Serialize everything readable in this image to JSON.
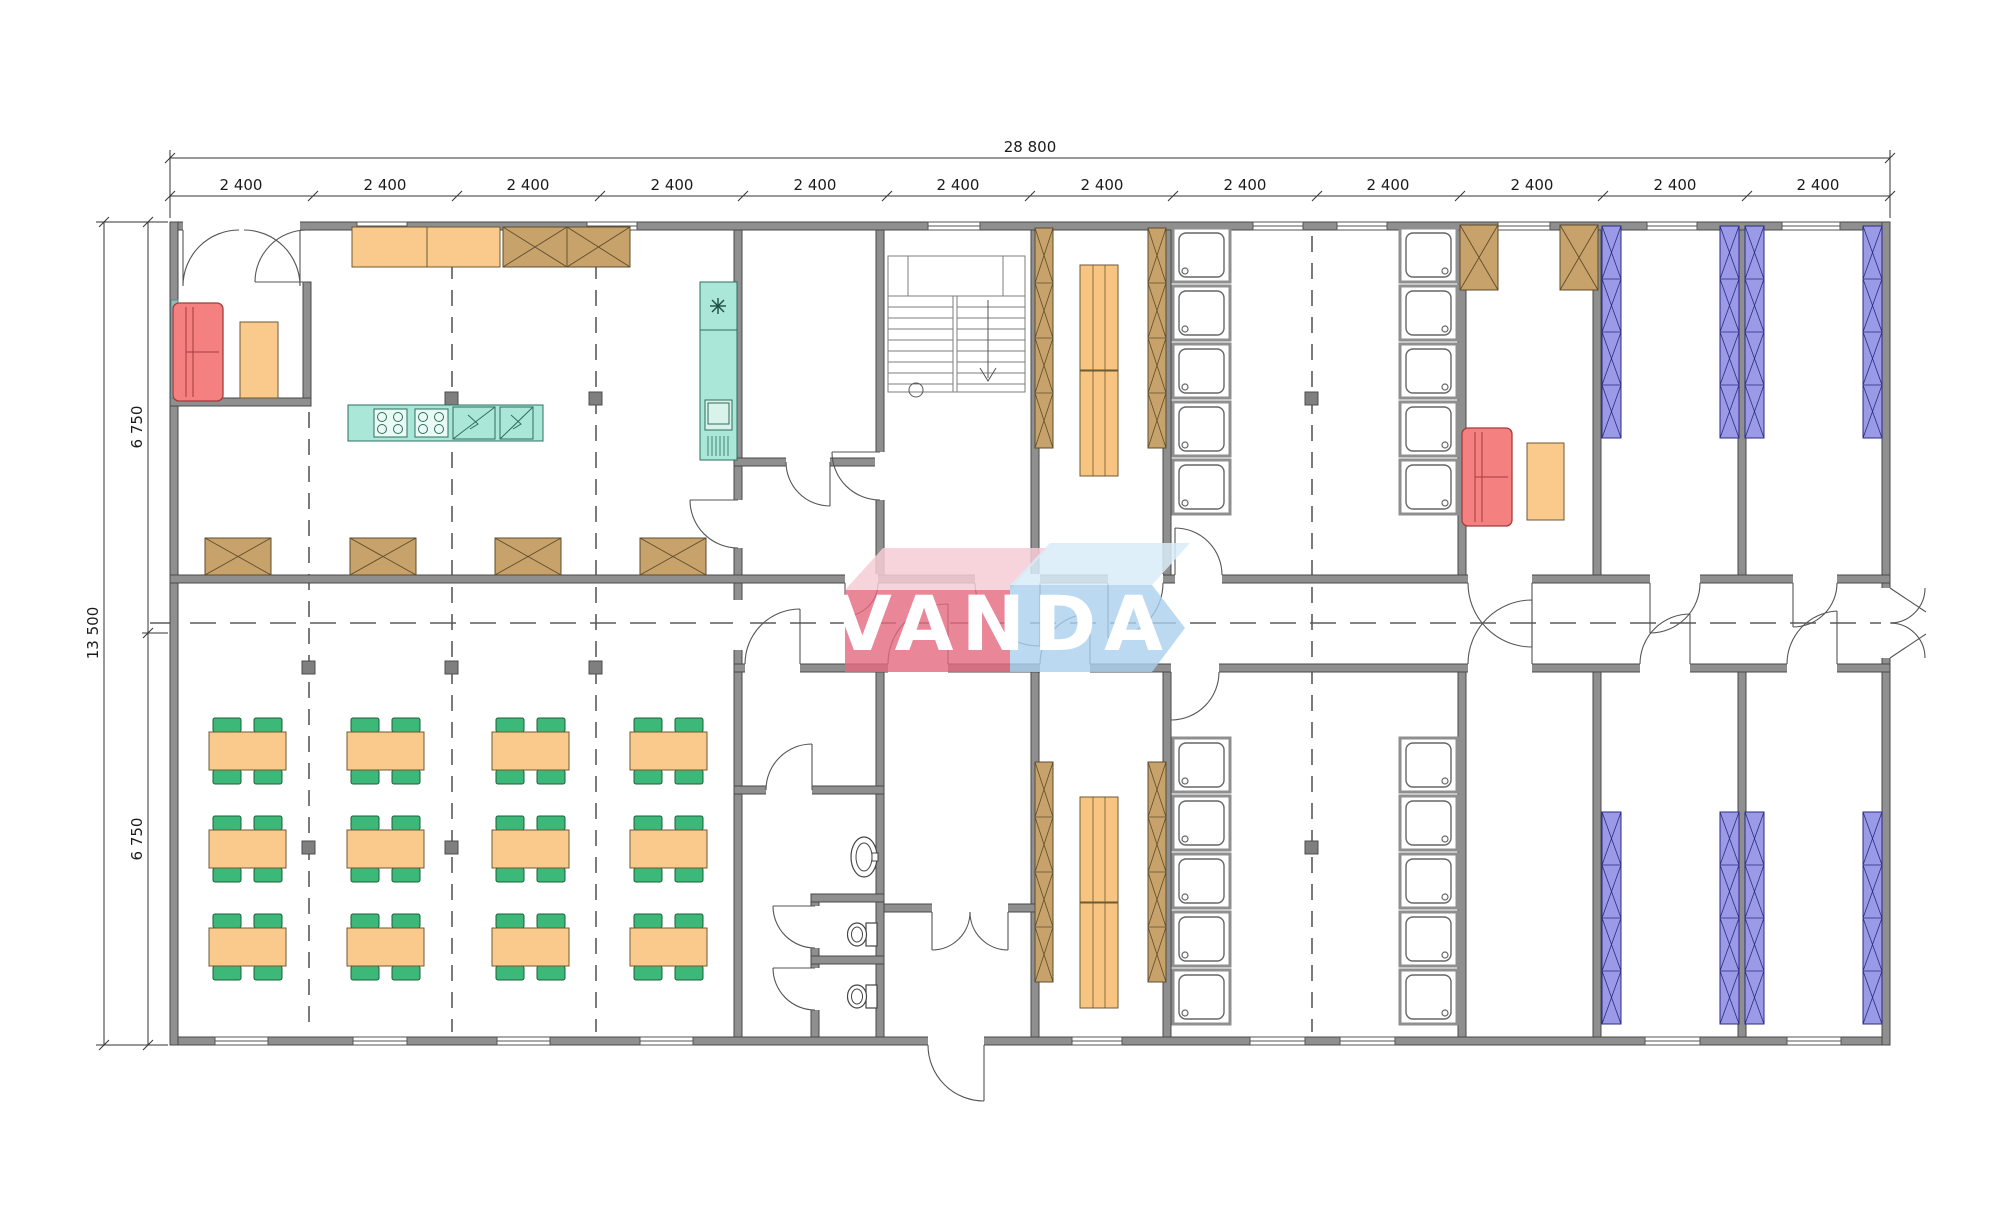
{
  "logo": {
    "text": "VANDA"
  },
  "dimensions": {
    "total_width": "28 800",
    "total_height": "13 500",
    "upper_half": "6 750",
    "lower_half": "6 750",
    "top_segments": [
      "2 400",
      "2 400",
      "2 400",
      "2 400",
      "2 400",
      "2 400",
      "2 400",
      "2 400",
      "2 400",
      "2 400",
      "2 400",
      "2 400"
    ]
  },
  "colors": {
    "wall": "#8f8f8f",
    "wood_brown": "#c7a26b",
    "furniture_orange": "#fac98c",
    "sofa_red": "#f48080",
    "kitchen_teal": "#abe7d9",
    "chair_green": "#3cb878",
    "bunk_purple": "#9a9ae6",
    "logo_pink": "#e4697f",
    "logo_pink_light": "#f6cdd6",
    "logo_blue": "#aacfec"
  },
  "inventory": {
    "dining_tables": 12,
    "dining_chairs": 48,
    "serving_tables": 4,
    "shower_stalls": 20,
    "toilets": 2,
    "washbasins": 1,
    "bunk_bed_racks": 8,
    "bench_sets": 4,
    "locker_columns": 4,
    "wardrobe_lockers": 4,
    "sofas": 2,
    "cooktops": 2,
    "kitchen_sinks": 2,
    "fridges": 1,
    "staircases": 1
  }
}
